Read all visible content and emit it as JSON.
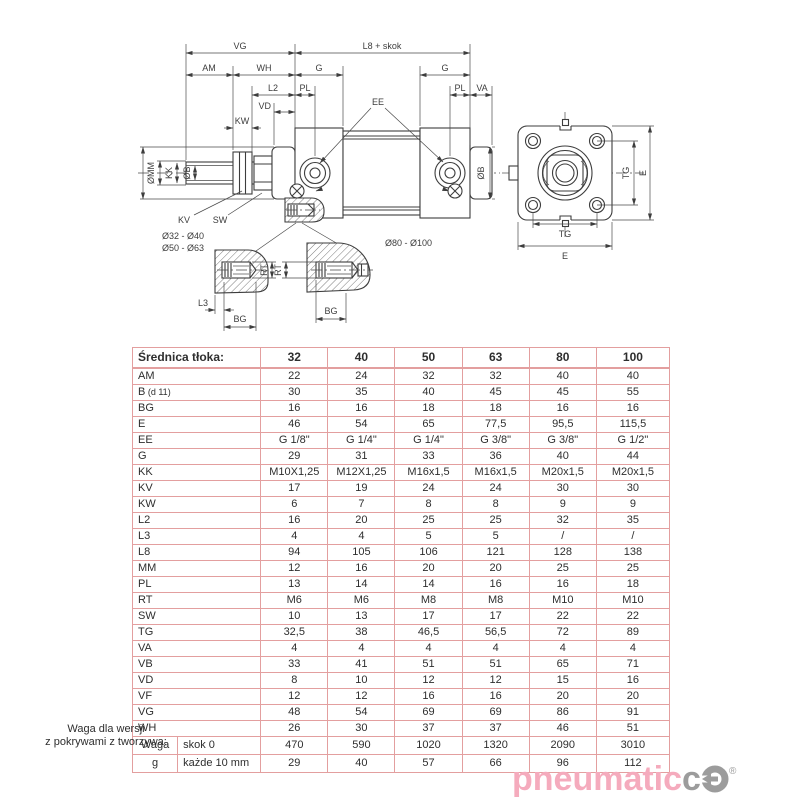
{
  "diagram": {
    "side_view": {
      "vg": "VG",
      "l8_skok": "L8 + skok",
      "am": "AM",
      "wh": "WH",
      "g_front": "G",
      "g_rear": "G",
      "l2": "L2",
      "pl_front": "PL",
      "pl_rear": "PL",
      "va": "VA",
      "vd": "VD",
      "kw": "KW",
      "ee": "EE",
      "dia_mm": "ØMM",
      "kk": "KK",
      "dia_b_front": "ØB",
      "dia_b_rear": "ØB",
      "kv": "KV",
      "sw": "SW"
    },
    "details": {
      "range_small_line1": "Ø32 - Ø40",
      "range_small_line2": "Ø50 - Ø63",
      "range_large": "Ø80 - Ø100",
      "l3": "L3",
      "bg_small": "BG",
      "bg_large": "BG",
      "rt_small": "RT",
      "rt_large": "RT"
    },
    "end_view": {
      "tg_v": "TG",
      "e_v": "E",
      "tg_h": "TG",
      "e_h": "E"
    }
  },
  "table": {
    "header_label": "Średnica tłoka:",
    "columns": [
      "32",
      "40",
      "50",
      "63",
      "80",
      "100"
    ],
    "rows": [
      {
        "label": "AM",
        "values": [
          "22",
          "24",
          "32",
          "32",
          "40",
          "40"
        ]
      },
      {
        "label": "B",
        "label_note": "(d 11)",
        "values": [
          "30",
          "35",
          "40",
          "45",
          "45",
          "55"
        ]
      },
      {
        "label": "BG",
        "values": [
          "16",
          "16",
          "18",
          "18",
          "16",
          "16"
        ]
      },
      {
        "label": "E",
        "values": [
          "46",
          "54",
          "65",
          "77,5",
          "95,5",
          "115,5"
        ]
      },
      {
        "label": "EE",
        "values": [
          "G 1/8\"",
          "G 1/4\"",
          "G 1/4\"",
          "G 3/8\"",
          "G 3/8\"",
          "G 1/2\""
        ]
      },
      {
        "label": "G",
        "values": [
          "29",
          "31",
          "33",
          "36",
          "40",
          "44"
        ]
      },
      {
        "label": "KK",
        "values": [
          "M10X1,25",
          "M12X1,25",
          "M16x1,5",
          "M16x1,5",
          "M20x1,5",
          "M20x1,5"
        ]
      },
      {
        "label": "KV",
        "values": [
          "17",
          "19",
          "24",
          "24",
          "30",
          "30"
        ]
      },
      {
        "label": "KW",
        "values": [
          "6",
          "7",
          "8",
          "8",
          "9",
          "9"
        ]
      },
      {
        "label": "L2",
        "values": [
          "16",
          "20",
          "25",
          "25",
          "32",
          "35"
        ]
      },
      {
        "label": "L3",
        "values": [
          "4",
          "4",
          "5",
          "5",
          "/",
          "/"
        ]
      },
      {
        "label": "L8",
        "values": [
          "94",
          "105",
          "106",
          "121",
          "128",
          "138"
        ]
      },
      {
        "label": "MM",
        "values": [
          "12",
          "16",
          "20",
          "20",
          "25",
          "25"
        ]
      },
      {
        "label": "PL",
        "values": [
          "13",
          "14",
          "14",
          "16",
          "16",
          "18"
        ]
      },
      {
        "label": "RT",
        "values": [
          "M6",
          "M6",
          "M8",
          "M8",
          "M10",
          "M10"
        ]
      },
      {
        "label": "SW",
        "values": [
          "10",
          "13",
          "17",
          "17",
          "22",
          "22"
        ]
      },
      {
        "label": "TG",
        "values": [
          "32,5",
          "38",
          "46,5",
          "56,5",
          "72",
          "89"
        ]
      },
      {
        "label": "VA",
        "values": [
          "4",
          "4",
          "4",
          "4",
          "4",
          "4"
        ]
      },
      {
        "label": "VB",
        "values": [
          "33",
          "41",
          "51",
          "51",
          "65",
          "71"
        ]
      },
      {
        "label": "VD",
        "values": [
          "8",
          "10",
          "12",
          "12",
          "15",
          "16"
        ]
      },
      {
        "label": "VF",
        "values": [
          "12",
          "12",
          "16",
          "16",
          "20",
          "20"
        ]
      },
      {
        "label": "VG",
        "values": [
          "48",
          "54",
          "69",
          "69",
          "86",
          "91"
        ]
      },
      {
        "label": "WH",
        "values": [
          "26",
          "30",
          "37",
          "37",
          "46",
          "51"
        ]
      }
    ],
    "weight_rows": [
      {
        "group": "Waga",
        "sub": "skok 0",
        "values": [
          "470",
          "590",
          "1020",
          "1320",
          "2090",
          "3010"
        ]
      },
      {
        "group": "g",
        "sub": "każde 10 mm",
        "values": [
          "29",
          "40",
          "57",
          "66",
          "96",
          "112"
        ]
      }
    ],
    "caption_line1": "Waga dla wersji",
    "caption_line2": "z pokrywami z tworzywa:"
  },
  "logo": {
    "text_pink": "pneumatic",
    "text_gray": "c",
    "reg": "®"
  },
  "colors": {
    "table_border": "#e39f9f",
    "logo_pink": "#f5abbd",
    "logo_gray": "#9c9c9c",
    "line": "#3d3d3d"
  }
}
